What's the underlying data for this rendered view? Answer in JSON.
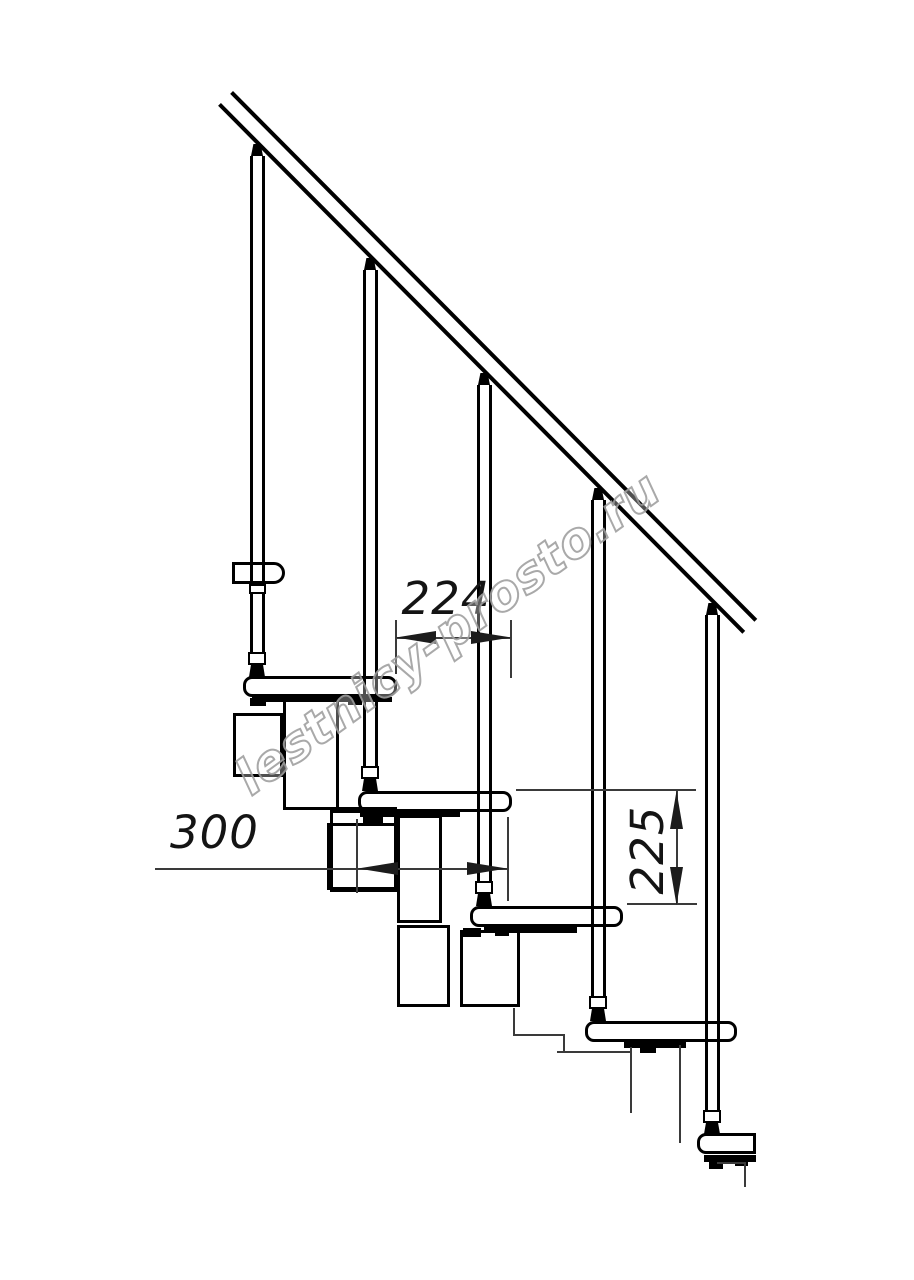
{
  "figure": {
    "watermark": {
      "text": "lestnicy-prosto.ru"
    },
    "dimensions": [
      {
        "id": "step-going-horizontal",
        "label": "224",
        "orientation": "horizontal"
      },
      {
        "id": "tread-length-horizontal",
        "label": "300",
        "orientation": "horizontal"
      },
      {
        "id": "step-rise-vertical",
        "label": "225",
        "orientation": "vertical"
      }
    ],
    "structure": {
      "balusters": 5,
      "full_steps": 5,
      "partial_steps": 1,
      "line_color": "#000000",
      "background_color": "#ffffff",
      "watermark_color": "#a0a0a0"
    }
  }
}
